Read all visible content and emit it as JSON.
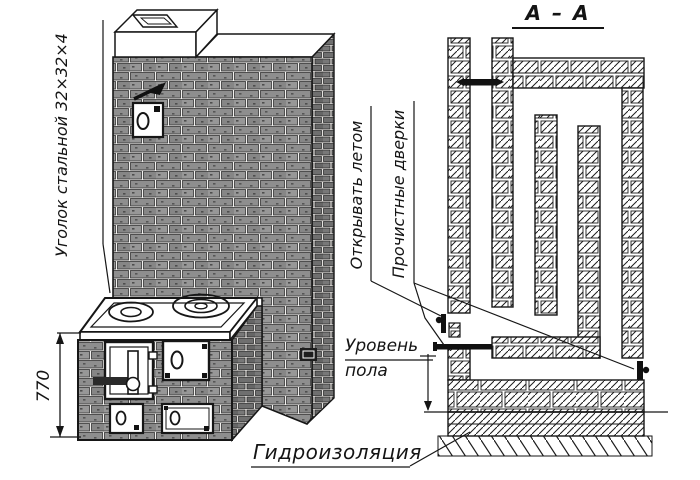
{
  "drawing": {
    "left_view": {
      "steel_angle_note": "Уголок стальной 32×32×4",
      "height_dimension": "770"
    },
    "section_view": {
      "title": "А – А",
      "open_in_summer_label": "Открывать летом",
      "cleanout_doors_label": "Прочистные дверки",
      "floor_level_word1": "Уровень",
      "floor_level_word2": "пола",
      "waterproofing_label": "Гидроизоляция"
    },
    "colors": {
      "ink": "#161616",
      "brick_front": "#8e8e8e",
      "brick_side": "#707070",
      "paper": "#ffffff"
    }
  }
}
